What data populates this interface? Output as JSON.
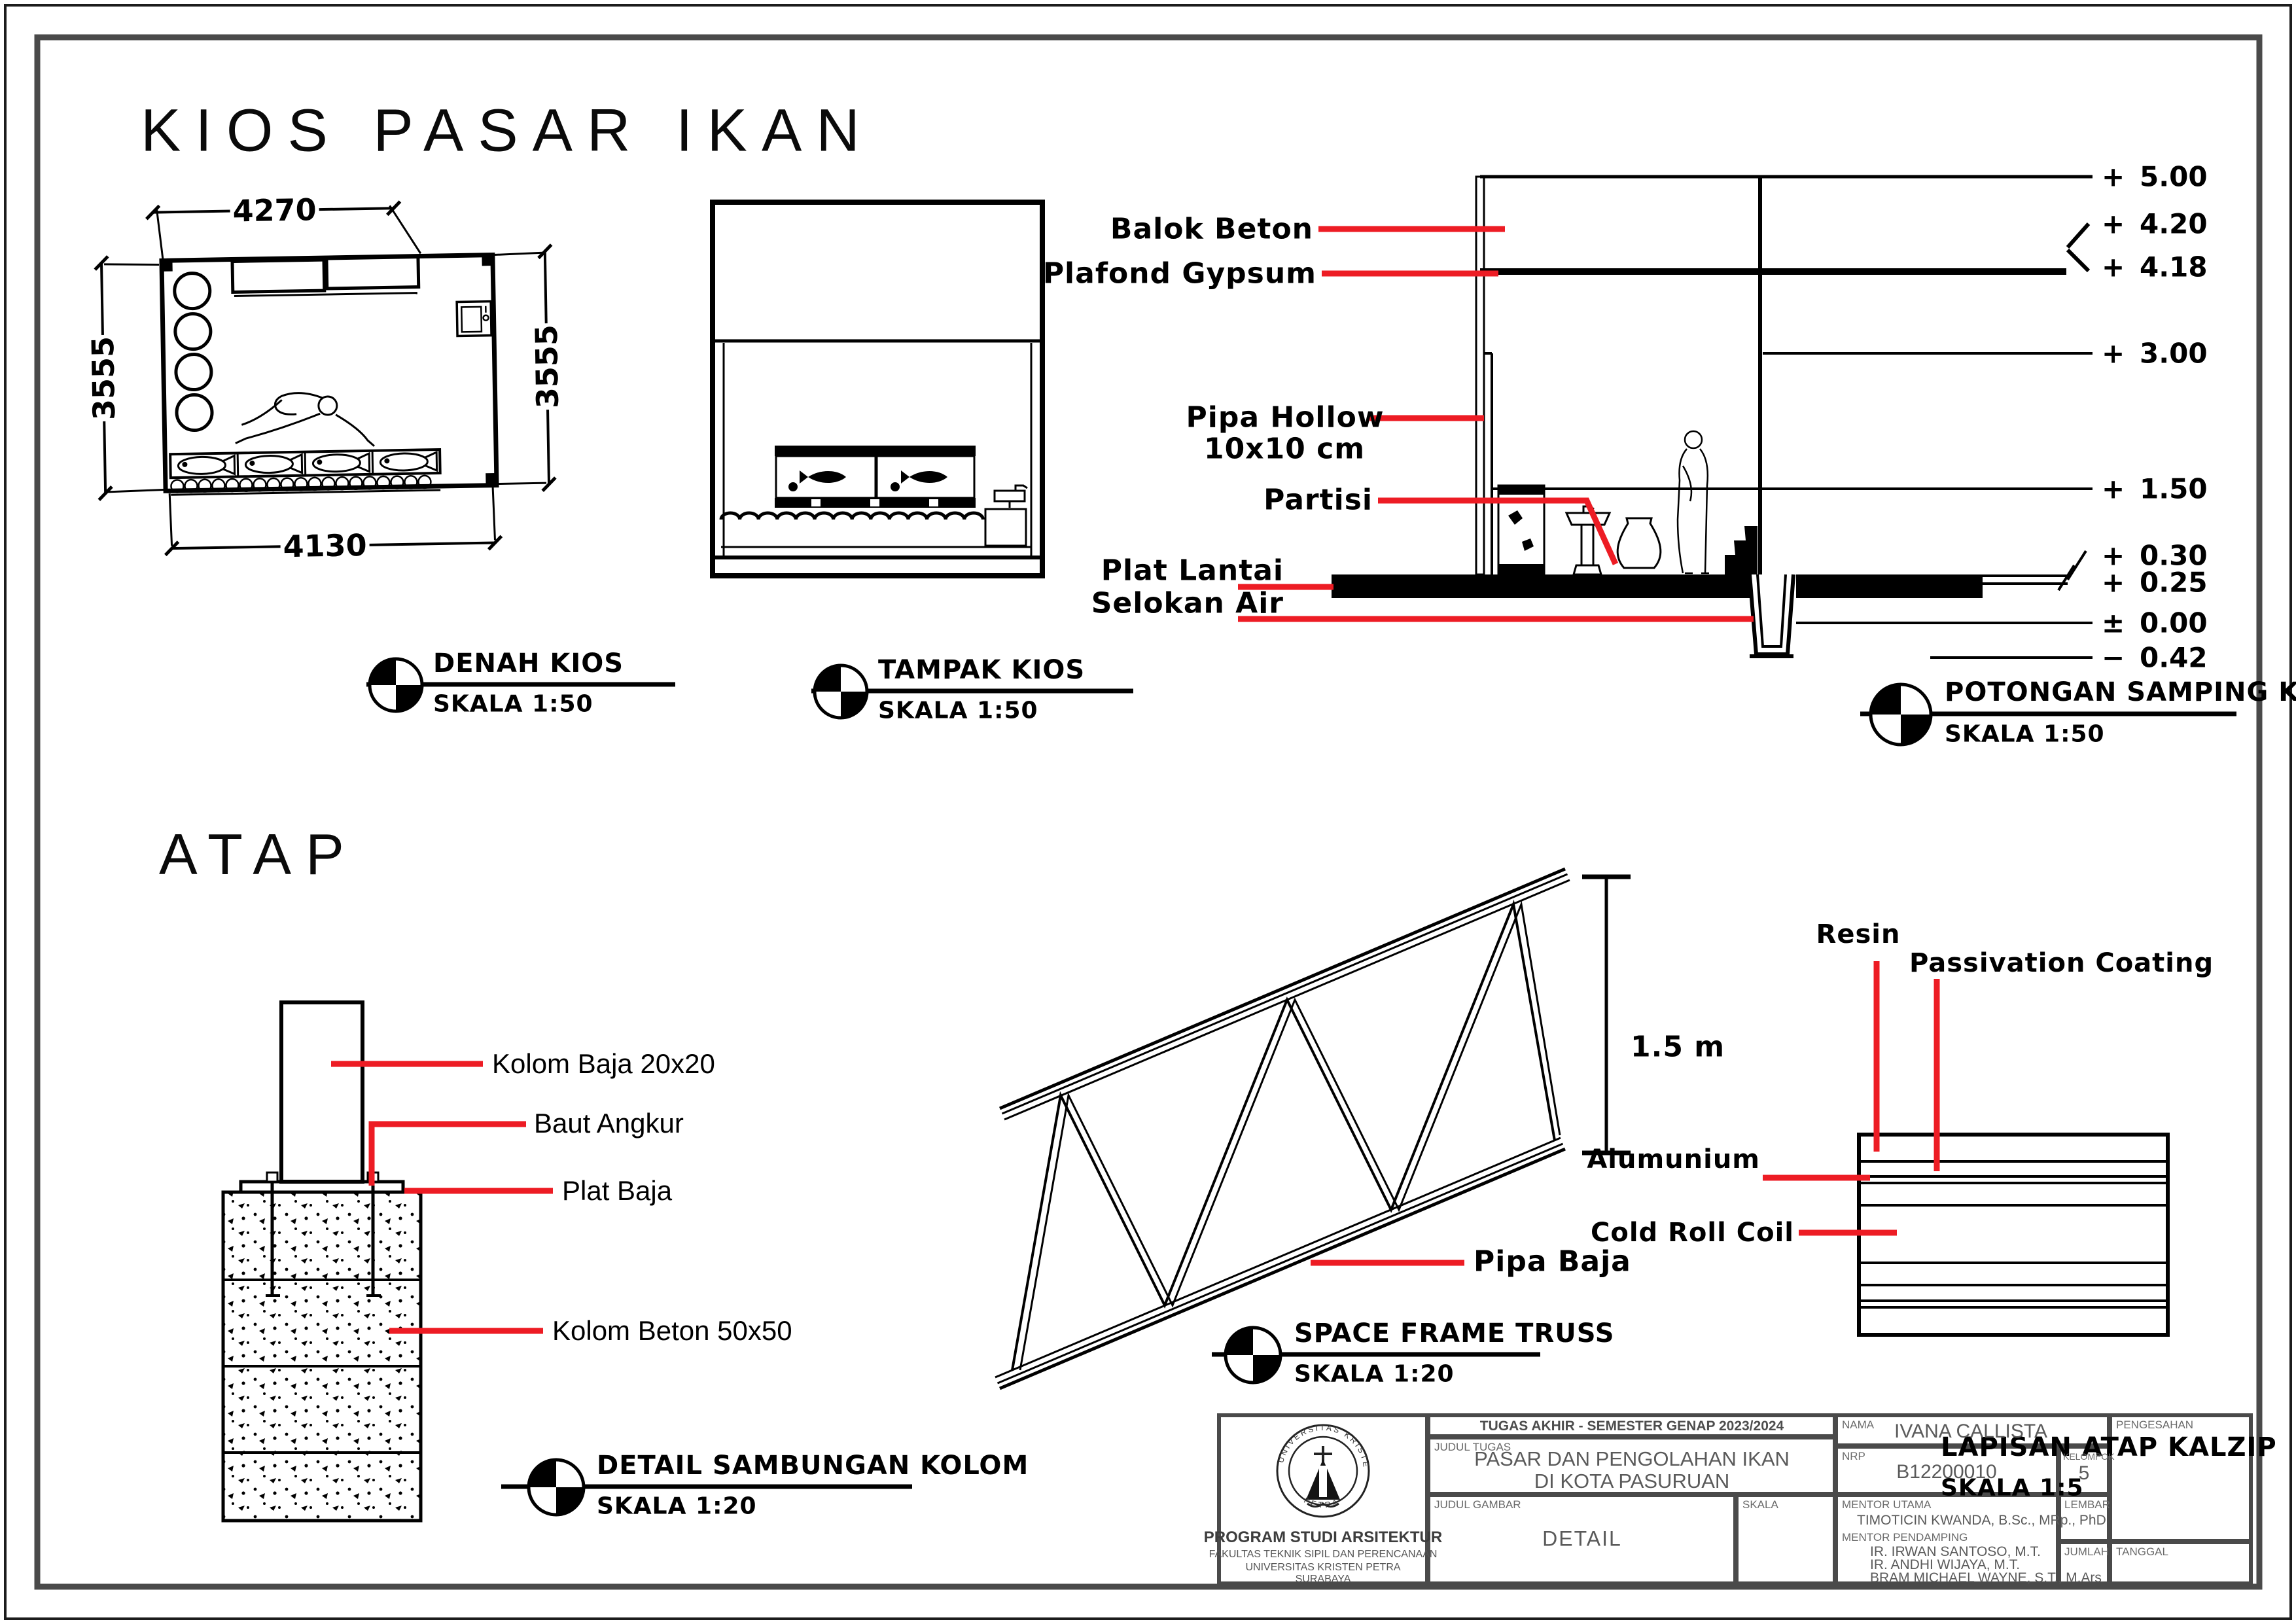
{
  "page": {
    "main_title": "KIOS PASAR IKAN",
    "atap_title": "ATAP"
  },
  "colors": {
    "accent_red": "#ed1c24",
    "titleblock_gray": "#4a4a4a",
    "line_black": "#000000"
  },
  "denah": {
    "marker_title": "DENAH KIOS",
    "marker_scale": "SKALA 1:50",
    "dim_top": "4270",
    "dim_bottom": "4130",
    "dim_left": "3555",
    "dim_right": "3555"
  },
  "tampak": {
    "marker_title": "TAMPAK KIOS",
    "marker_scale": "SKALA 1:50"
  },
  "potongan": {
    "marker_title": "POTONGAN SAMPING KIOS",
    "marker_scale": "SKALA 1:50",
    "labels": {
      "balok": "Balok Beton",
      "plafond": "Plafond Gypsum",
      "pipa1": "Pipa Hollow",
      "pipa2": "10x10 cm",
      "partisi": "Partisi",
      "plat": "Plat Lantai",
      "selokan": "Selokan Air"
    },
    "levels": [
      {
        "sign": "+",
        "value": "5.00"
      },
      {
        "sign": "+",
        "value": "4.20"
      },
      {
        "sign": "+",
        "value": "4.18"
      },
      {
        "sign": "+",
        "value": "3.00"
      },
      {
        "sign": "+",
        "value": "1.50"
      },
      {
        "sign": "+",
        "value": "0.30"
      },
      {
        "sign": "+",
        "value": "0.25"
      },
      {
        "sign": "±",
        "value": "0.00"
      },
      {
        "sign": "−",
        "value": "0.42"
      }
    ]
  },
  "detail_kolom": {
    "marker_title": "DETAIL SAMBUNGAN KOLOM",
    "marker_scale": "SKALA 1:20",
    "labels": {
      "kolom_baja": "Kolom Baja 20x20",
      "baut": "Baut Angkur",
      "plat": "Plat Baja",
      "kolom_beton": "Kolom Beton 50x50"
    }
  },
  "truss": {
    "marker_title": "SPACE FRAME TRUSS",
    "marker_scale": "SKALA 1:20",
    "dim": "1.5 m",
    "label_pipa": "Pipa Baja"
  },
  "kalzip": {
    "marker_title": "LAPISAN ATAP KALZIP",
    "marker_scale": "SKALA 1:5",
    "labels": {
      "resin": "Resin",
      "passivation": "Passivation Coating",
      "alu": "Alumunium",
      "coil": "Cold Roll Coil"
    }
  },
  "titleblock": {
    "header": "TUGAS AKHIR - SEMESTER GENAP 2023/2024",
    "judul_tugas_label": "JUDUL TUGAS",
    "judul_tugas_1": "PASAR DAN PENGOLAHAN IKAN",
    "judul_tugas_2": "DI KOTA PASURUAN",
    "judul_gambar_label": "JUDUL GAMBAR",
    "judul_gambar": "DETAIL",
    "skala_label": "SKALA",
    "nama_label": "NAMA",
    "nama": "IVANA CALLISTA",
    "nrp_label": "NRP",
    "nrp": "B12200010",
    "kelompok_label": "KELOMPOK",
    "kelompok": "5",
    "mentor_utama_label": "MENTOR UTAMA",
    "mentor_utama": "TIMOTICIN KWANDA,  B.Sc., MRp., PhD",
    "mentor_pendamping_label": "MENTOR PENDAMPING",
    "pendamping_1": "IR. IRWAN SANTOSO, M.T.",
    "pendamping_2": "IR. ANDHI WIJAYA, M.T.",
    "pendamping_3": "BRAM MICHAEL WAYNE, S.T., M.Ars",
    "lembar_label": "LEMBAR",
    "jumlah_label": "JUMLAH",
    "tanggal_label": "TANGGAL",
    "pengesahan_label": "PENGESAHAN",
    "program": "PROGRAM STUDI ARSITEKTUR",
    "fakultas": "FAKULTAS TEKNIK SIPIL DAN PERENCANAAN",
    "universitas": "UNIVERSITAS KRISTEN PETRA",
    "kota": "SURABAYA",
    "logo_top": "UNIVERSITAS KRISTEN",
    "logo_bottom": "PETRA"
  }
}
